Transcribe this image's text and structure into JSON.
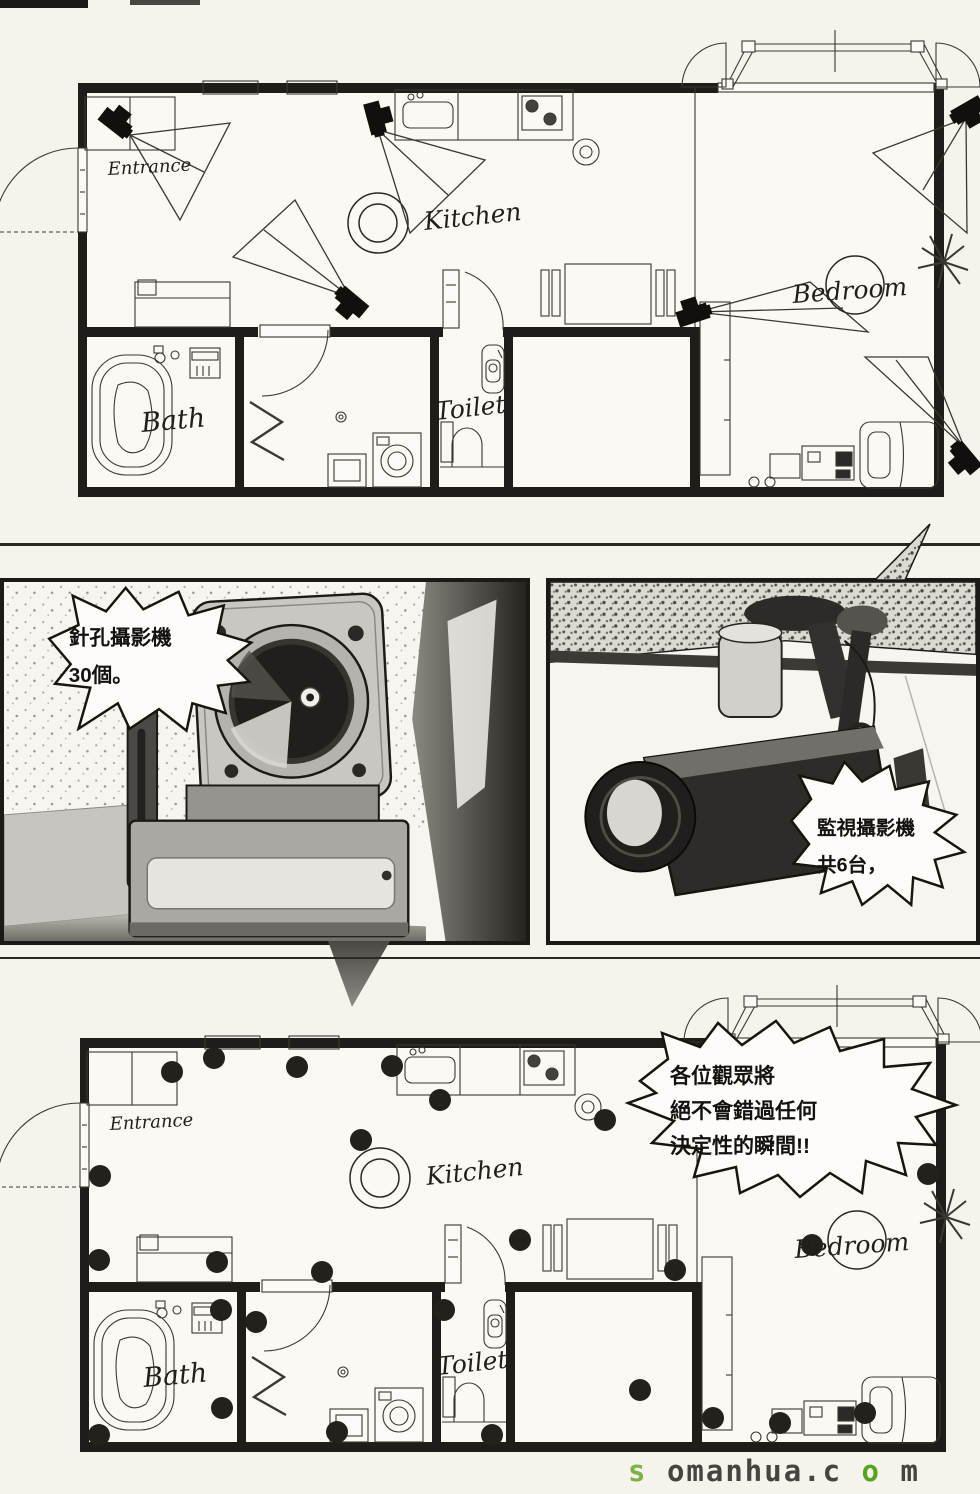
{
  "page": {
    "bg_color": "#f5f3ec",
    "ink_color": "#1c1a17",
    "watermark": {
      "segments": [
        {
          "text": "s",
          "color": "#7cb342"
        },
        {
          "text": "omanhua.c",
          "color": "#45443f"
        },
        {
          "text": "o",
          "color": "#55a41e"
        },
        {
          "text": "m",
          "color": "#45443f"
        }
      ]
    }
  },
  "floorplan": {
    "labels": {
      "entrance": "Entrance",
      "kitchen": "Kitchen",
      "bedroom": "Bedroom",
      "bath": "Bath",
      "toilet": "Toilet"
    }
  },
  "bubbles": {
    "pinhole": {
      "lines": [
        "針孔攝影機",
        "30個。"
      ]
    },
    "surveillance": {
      "lines": [
        "監視攝影機",
        "共6台，"
      ]
    },
    "announcement": {
      "lines": [
        "各位觀眾將",
        "絕不會錯過任何",
        "決定性的瞬間!!"
      ]
    }
  }
}
